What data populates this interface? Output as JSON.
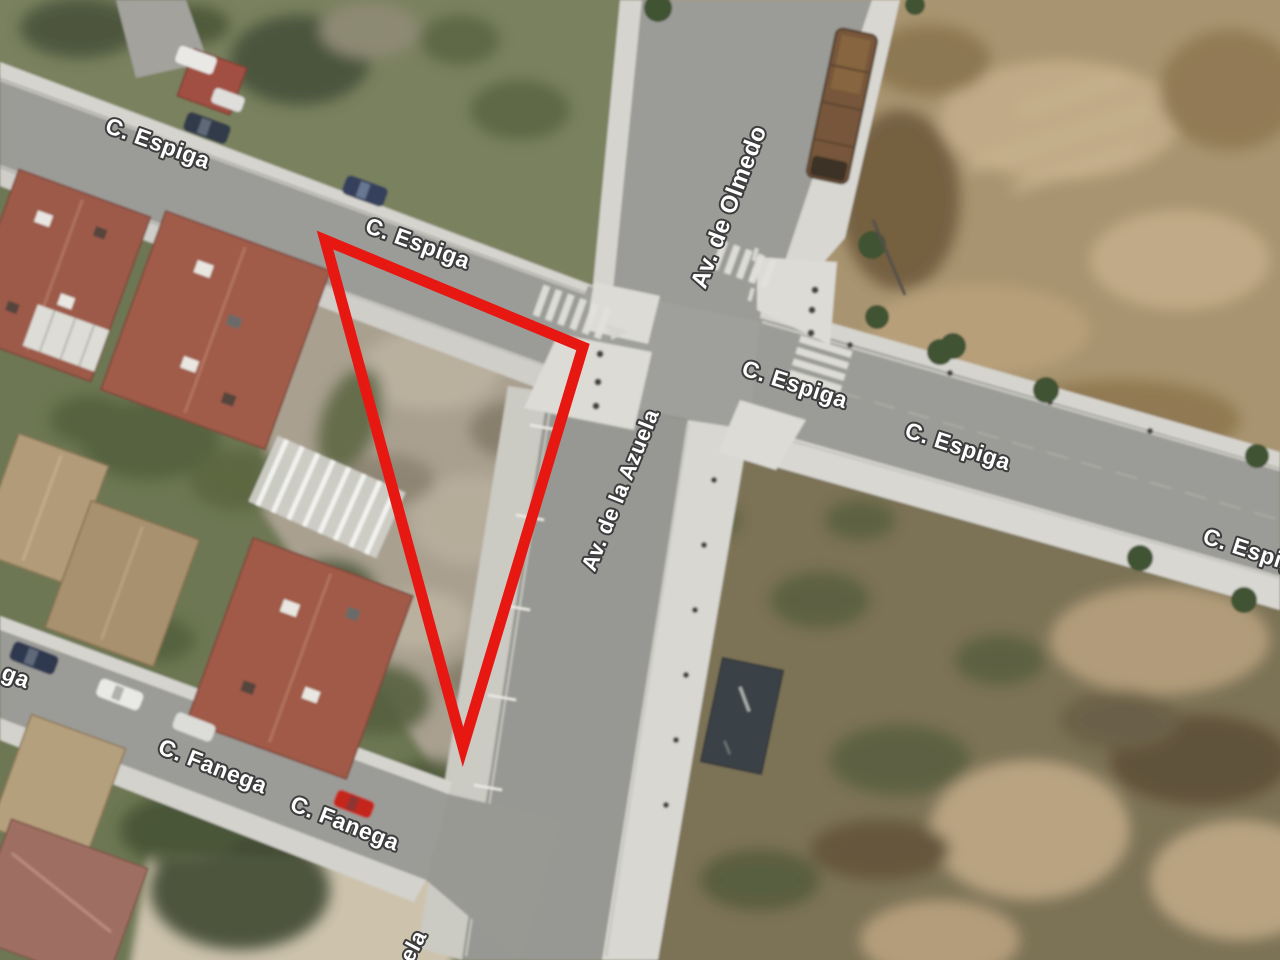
{
  "map": {
    "imagery": "aerial-satellite",
    "annotation": {
      "shape": "triangle-outline",
      "color": "#e71712",
      "stroke_width": 11,
      "points": "325,240 583,347 463,747"
    },
    "labels": [
      {
        "id": "c-espiga-1",
        "text": "C. Espiga"
      },
      {
        "id": "c-espiga-2",
        "text": "C. Espiga"
      },
      {
        "id": "av-de-olmedo",
        "text": "Av. de Olmedo"
      },
      {
        "id": "c-espiga-3",
        "text": "C. Espiga"
      },
      {
        "id": "c-espiga-4",
        "text": "C. Espiga"
      },
      {
        "id": "c-espiga-5",
        "text": "C. Espiga"
      },
      {
        "id": "av-de-la-azuela",
        "text": "Av. de la Azuela"
      },
      {
        "id": "c-fanega-partial",
        "text": "ga"
      },
      {
        "id": "c-fanega-1",
        "text": "C. Fanega"
      },
      {
        "id": "c-fanega-2",
        "text": "C. Fanega"
      },
      {
        "id": "av-azuela-partial",
        "text": "ela"
      }
    ],
    "label_style": {
      "fill": "#ffffff",
      "outline": "#3d3d3d"
    },
    "colors": {
      "road": "#9b9b97",
      "sidewalk": "#d8d7d1",
      "dirt_field": "#a8946f",
      "scrub_field": "#7b7256",
      "vacant_plot": "#a9a090",
      "vegetation": "#6d7752",
      "roof_red": "#9d5a49",
      "roof_tan": "#b09a78",
      "pool_dark": "#3a4247",
      "truck_brown": "#77573a",
      "car_red": "#c4251d",
      "car_dark_blue": "#36415b",
      "car_white": "#e9e9e5"
    }
  }
}
